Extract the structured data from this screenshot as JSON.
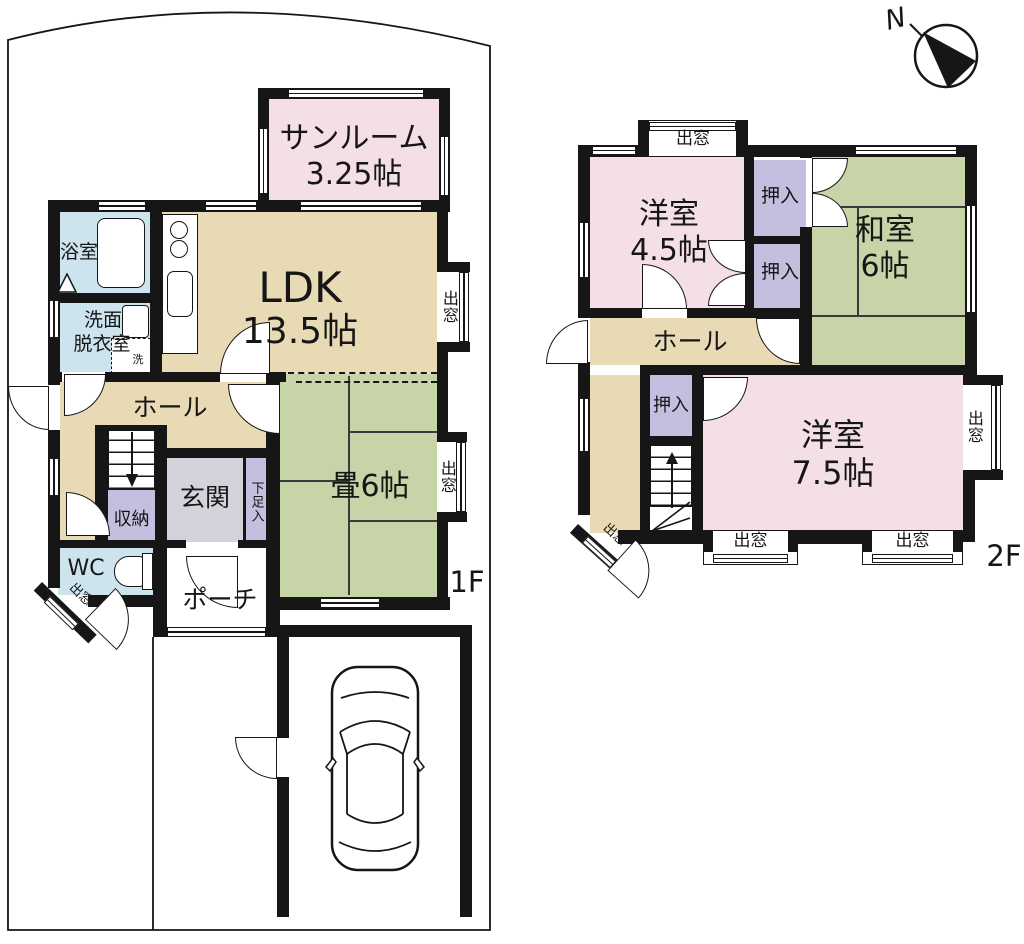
{
  "page": {
    "background": "#ffffff"
  },
  "colors": {
    "room_pink": "#f4dfe9",
    "room_beige": "#e9dab6",
    "room_green": "#c6d4a7",
    "room_blue": "#cde3ee",
    "room_lavender": "#c2bfdf",
    "room_gray": "#d4d3db",
    "wall": "#161616"
  },
  "compass": {
    "north_label": "N"
  },
  "floor1": {
    "floor_label": "1F",
    "sunroom_name": "サンルーム",
    "sunroom_size": "3.25帖",
    "ldk_name": "LDK",
    "ldk_size": "13.5帖",
    "bath": "浴室",
    "washroom_line1": "洗面",
    "washroom_line2": "脱衣室",
    "washer": "洗",
    "hall": "ホール",
    "storage": "収納",
    "entrance": "玄関",
    "shoe_cabinet": "下足入",
    "tatami": "畳6帖",
    "wc": "WC",
    "porch": "ポーチ",
    "bay_ldk": "出窓",
    "bay_tatami": "出窓",
    "bay_wc": "出窓"
  },
  "floor2": {
    "floor_label": "2F",
    "west1_name": "洋室",
    "west1_size": "4.5帖",
    "closet_a": "押入",
    "closet_b": "押入",
    "closet_c": "押入",
    "japanese_name": "和室",
    "japanese_size": "6帖",
    "hall": "ホール",
    "west2_name": "洋室",
    "west2_size": "7.5帖",
    "bay_top": "出窓",
    "bay_right": "出窓",
    "bay_bottom_left": "出窓",
    "bay_bottom_right": "出窓",
    "bay_corner": "出窓"
  }
}
